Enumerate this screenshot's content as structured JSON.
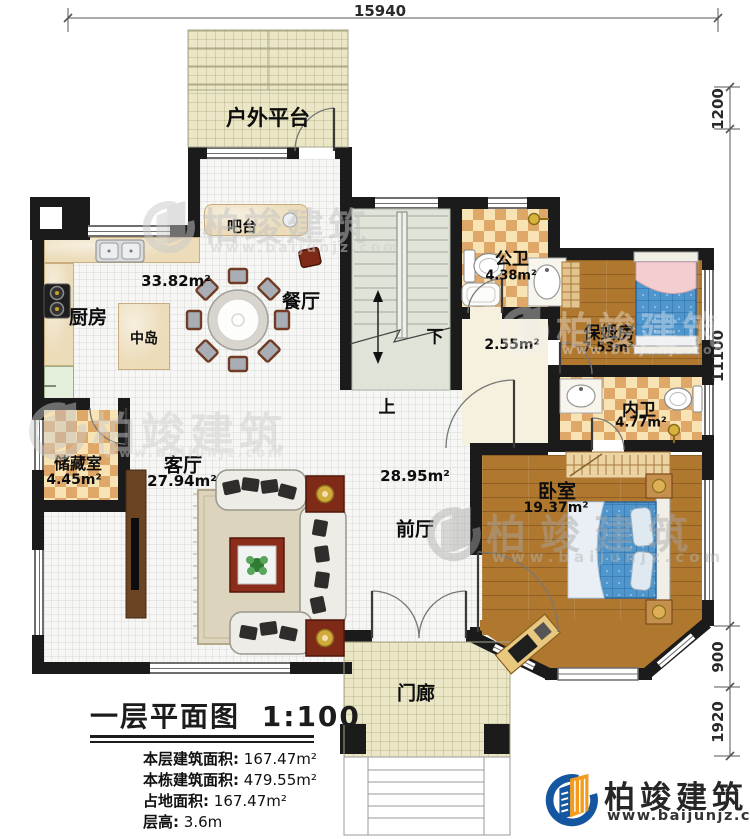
{
  "dimensions": {
    "top": "15940",
    "right": [
      "1200",
      "11100",
      "900",
      "1920"
    ]
  },
  "rooms": {
    "outdoor_platform": {
      "label": "户外平台"
    },
    "bar": {
      "label": "吧台"
    },
    "kitchen": {
      "label": "厨房"
    },
    "island": {
      "label": "中岛"
    },
    "dining": {
      "label": "餐厅",
      "area": "33.82m²"
    },
    "public_bath": {
      "label": "公卫",
      "area": "4.38m²"
    },
    "hall": {
      "area": "2.55m²"
    },
    "nanny_room": {
      "label": "保姆房",
      "area": "7.53m²"
    },
    "inner_bath": {
      "label": "内卫",
      "area": "4.77m²"
    },
    "bedroom": {
      "label": "卧室",
      "area": "19.37m²"
    },
    "front_hall": {
      "label": "前厅",
      "area": "28.95m²"
    },
    "living_room": {
      "label": "客厅",
      "area": "27.94m²"
    },
    "storage": {
      "label": "储藏室",
      "area": "4.45m²"
    },
    "porch": {
      "label": "门廊"
    }
  },
  "stairs": {
    "down": "下",
    "up": "上"
  },
  "title_block": {
    "title": "一层平面图",
    "scale": "1:100",
    "stats": [
      {
        "label": "本层建筑面积:",
        "value": "167.47m²"
      },
      {
        "label": "本栋建筑面积:",
        "value": "479.55m²"
      },
      {
        "label": "占地面积:",
        "value": "167.47m²"
      },
      {
        "label": "层高:",
        "value": "3.6m"
      }
    ]
  },
  "branding": {
    "name": "柏竣建筑",
    "url": "www.baijunjz.com"
  },
  "colors": {
    "brand_blue": "#1456a0",
    "brand_orange": "#f29b1d",
    "wall": "#1b1b1b",
    "wood": "#b0782f",
    "bed_blue": "#4f96cd"
  }
}
